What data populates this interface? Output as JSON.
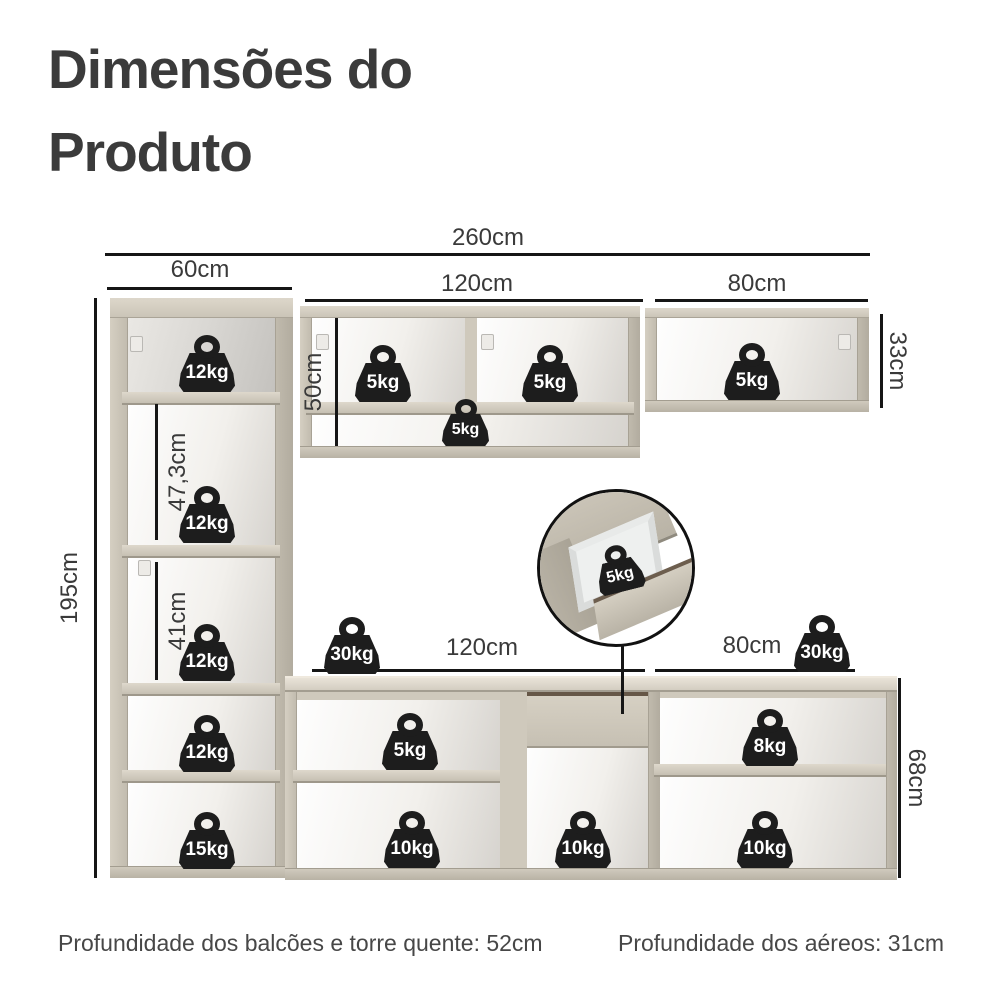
{
  "title": "Dimensões do Produto",
  "dimensions": {
    "total_width": "260cm",
    "tower_width": "60cm",
    "upper_middle_width": "120cm",
    "upper_right_width": "80cm",
    "tower_height": "195cm",
    "tower_middle_section_height": "47,3cm",
    "tower_lower_section_height": "41cm",
    "upper_middle_height": "50cm",
    "upper_right_height": "33cm",
    "counter_left_width": "120cm",
    "counter_right_width": "80cm",
    "counter_height": "68cm"
  },
  "weights": {
    "tower_top": "12kg",
    "tower_middle": "12kg",
    "tower_lower": "12kg",
    "tower_base_upper": "12kg",
    "tower_base_lower": "15kg",
    "upper_middle_left": "5kg",
    "upper_middle_right": "5kg",
    "upper_middle_shelf": "5kg",
    "upper_right": "5kg",
    "drawer_detail": "5kg",
    "counter_left_total": "30kg",
    "counter_right_total": "30kg",
    "counter_left_shelf": "5kg",
    "counter_left_bottom": "10kg",
    "counter_middle_bottom": "10kg",
    "counter_right_shelf": "8kg",
    "counter_right_bottom": "10kg"
  },
  "footer": {
    "counters_depth": "Profundidade dos balcões e torre quente: 52cm",
    "uppers_depth": "Profundidade dos aéreos: 31cm"
  },
  "colors": {
    "cabinet_frame": "#cdc7ba",
    "dimension_line": "#161616",
    "weight_fill": "#1d1d1d",
    "text": "#3b3b3b"
  }
}
